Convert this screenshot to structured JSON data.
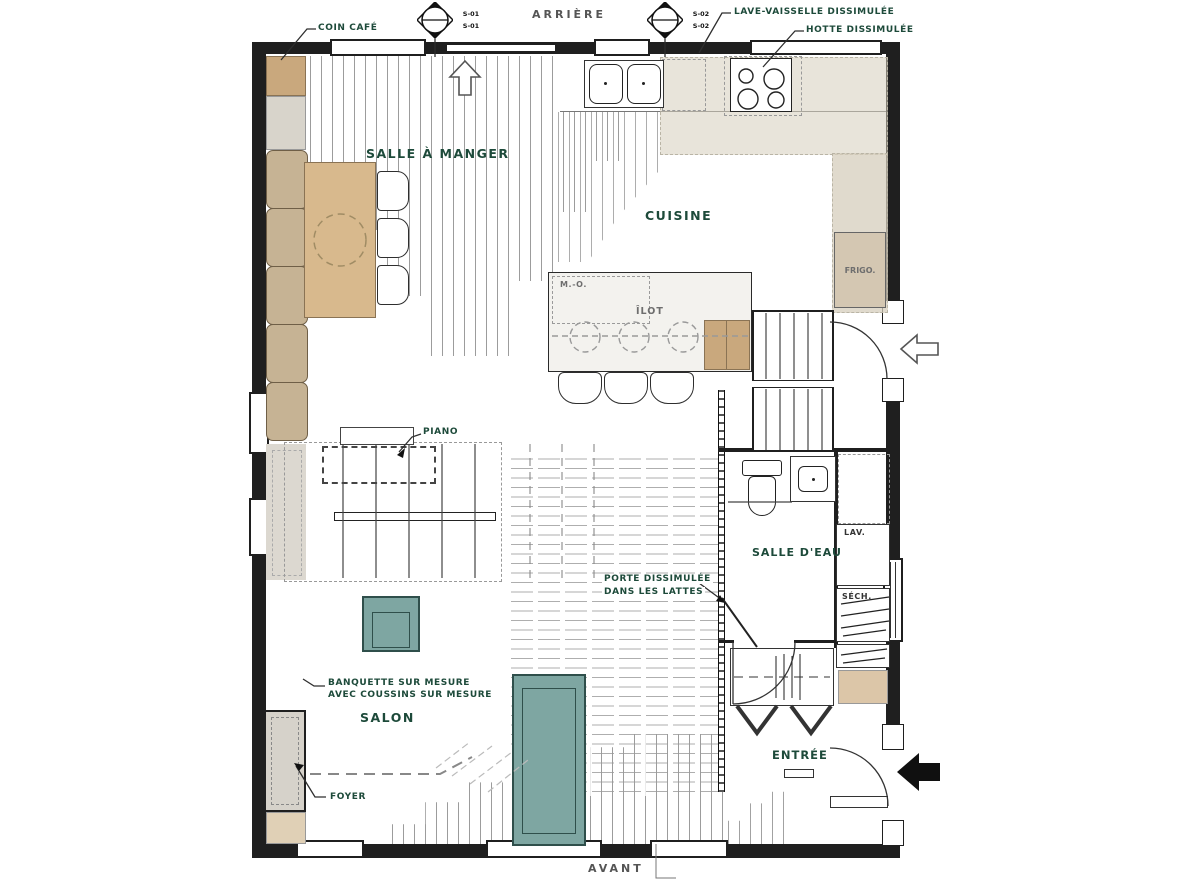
{
  "orientation": {
    "back": "ARRIÈRE",
    "front": "AVANT"
  },
  "markers": [
    {
      "top": "S-01",
      "bottom": "S-01"
    },
    {
      "top": "S-02",
      "bottom": "S-02"
    }
  ],
  "rooms": {
    "dining": "SALLE À MANGER",
    "kitchen": "CUISINE",
    "living": "SALON",
    "bath": "SALLE D'EAU",
    "entry": "ENTRÉE"
  },
  "annotations": {
    "coin_cafe": "COIN CAFÉ",
    "lave_vaisselle": "LAVE-VAISSELLE DISSIMULÉE",
    "hotte": "HOTTE DISSIMULÉE",
    "frigo": "FRIGO.",
    "micro": "M.-O.",
    "ilot": "ÎLOT",
    "piano": "PIANO",
    "lav": "LAV.",
    "sech": "SÉCH.",
    "porte_line1": "PORTE DISSIMULÉE",
    "porte_line2": "DANS LES LATTES",
    "banquette_line1": "BANQUETTE SUR MESURE",
    "banquette_line2": "AVEC COUSSINS SUR MESURE",
    "foyer": "FOYER"
  },
  "colors": {
    "wall": "#1f1f1f",
    "wood": "#d8b98d",
    "cabinet_beige": "#d6cfbc",
    "cushion_beige": "#c6b394",
    "teal_furniture": "#7ea6a2",
    "label_green": "#1d4a3a",
    "label_gray": "#6e6e6e"
  }
}
